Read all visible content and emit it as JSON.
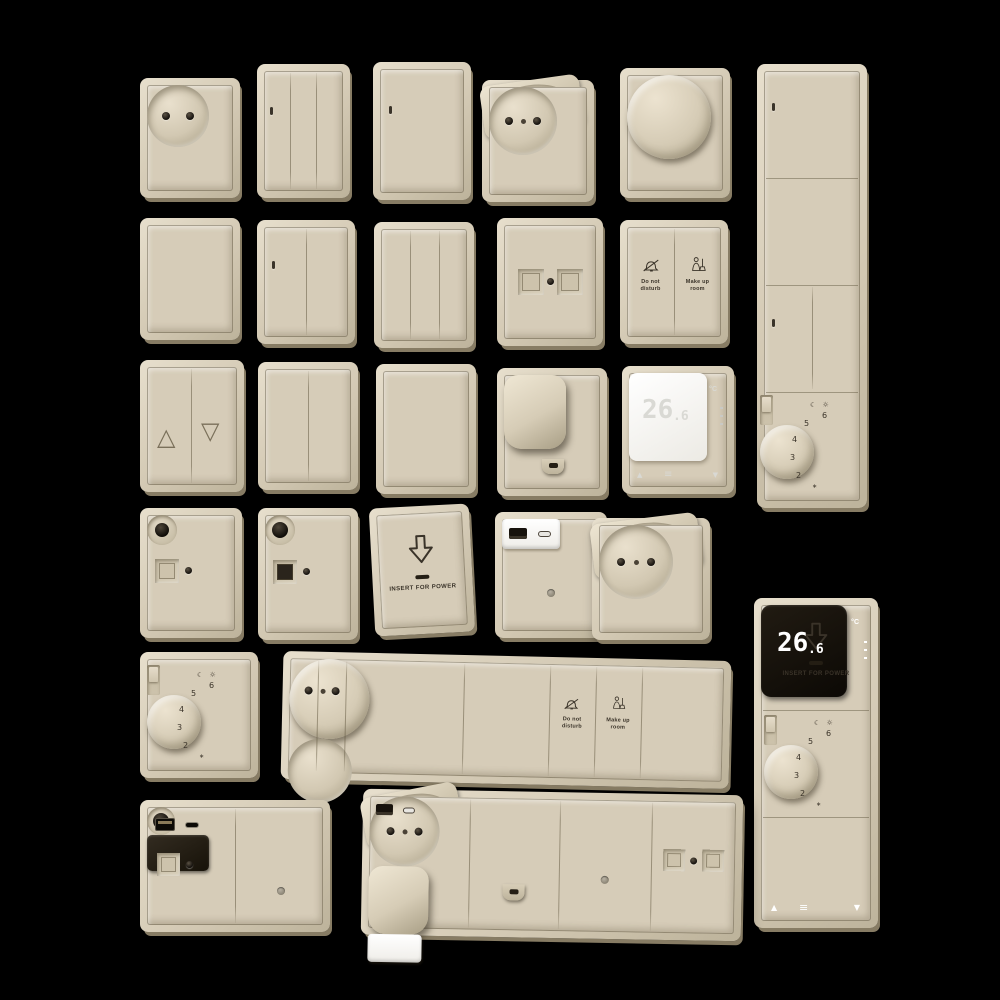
{
  "scene": {
    "background": "#000000",
    "description_colors": {
      "plate_face": "#d6ccb8",
      "plate_edge_light": "#e7dfcd",
      "plate_edge_dark": "#877c64",
      "engraving": "#3a3329",
      "hole_dark": "#181410",
      "module_white": "#ffffff",
      "module_black": "#15100a",
      "digits_on_white": "#d9d9d4",
      "digits_on_black": "#ffffff"
    }
  },
  "labels": {
    "do_not_disturb": "Do not\ndisturb",
    "make_up_room": "Make up\nroom",
    "insert_for_power": "INSERT FOR POWER"
  },
  "thermostat_display": {
    "value_main": "26",
    "value_decimal": ".6",
    "unit": "°C"
  },
  "thermostat_dial": {
    "scale": [
      "6",
      "5",
      "4",
      "3",
      "2"
    ],
    "mode_icons": "☾ ☼",
    "frost_icon": "∗"
  },
  "glyphs": {
    "blind_up": "△",
    "blind_down": "▽",
    "arrow_up": "▲",
    "arrow_down": "▼",
    "menu": "≡"
  },
  "devices": [
    "unearthed-socket",
    "3-gang-switch",
    "1-gang-switch",
    "flip-lid-socket",
    "rotary-dimmer",
    "4-module-vertical-panel",
    "blank-plate",
    "2-gang-switch",
    "3-gang-switch",
    "data-outlet-2-port",
    "do-not-disturb-make-up-room-switch",
    "blind-control-switch",
    "2-gang-switch",
    "1-gang-switch",
    "cable-outlet",
    "digital-thermostat-white",
    "tv-coax-outlet",
    "tv-coax-outlet",
    "key-card-holder",
    "usb-charger-outlet",
    "flip-lid-socket",
    "analog-thermostat",
    "6-module-horizontal-panel",
    "3-module-vertical-panel",
    "coax-usb-double-plate",
    "4-module-horizontal-panel"
  ]
}
